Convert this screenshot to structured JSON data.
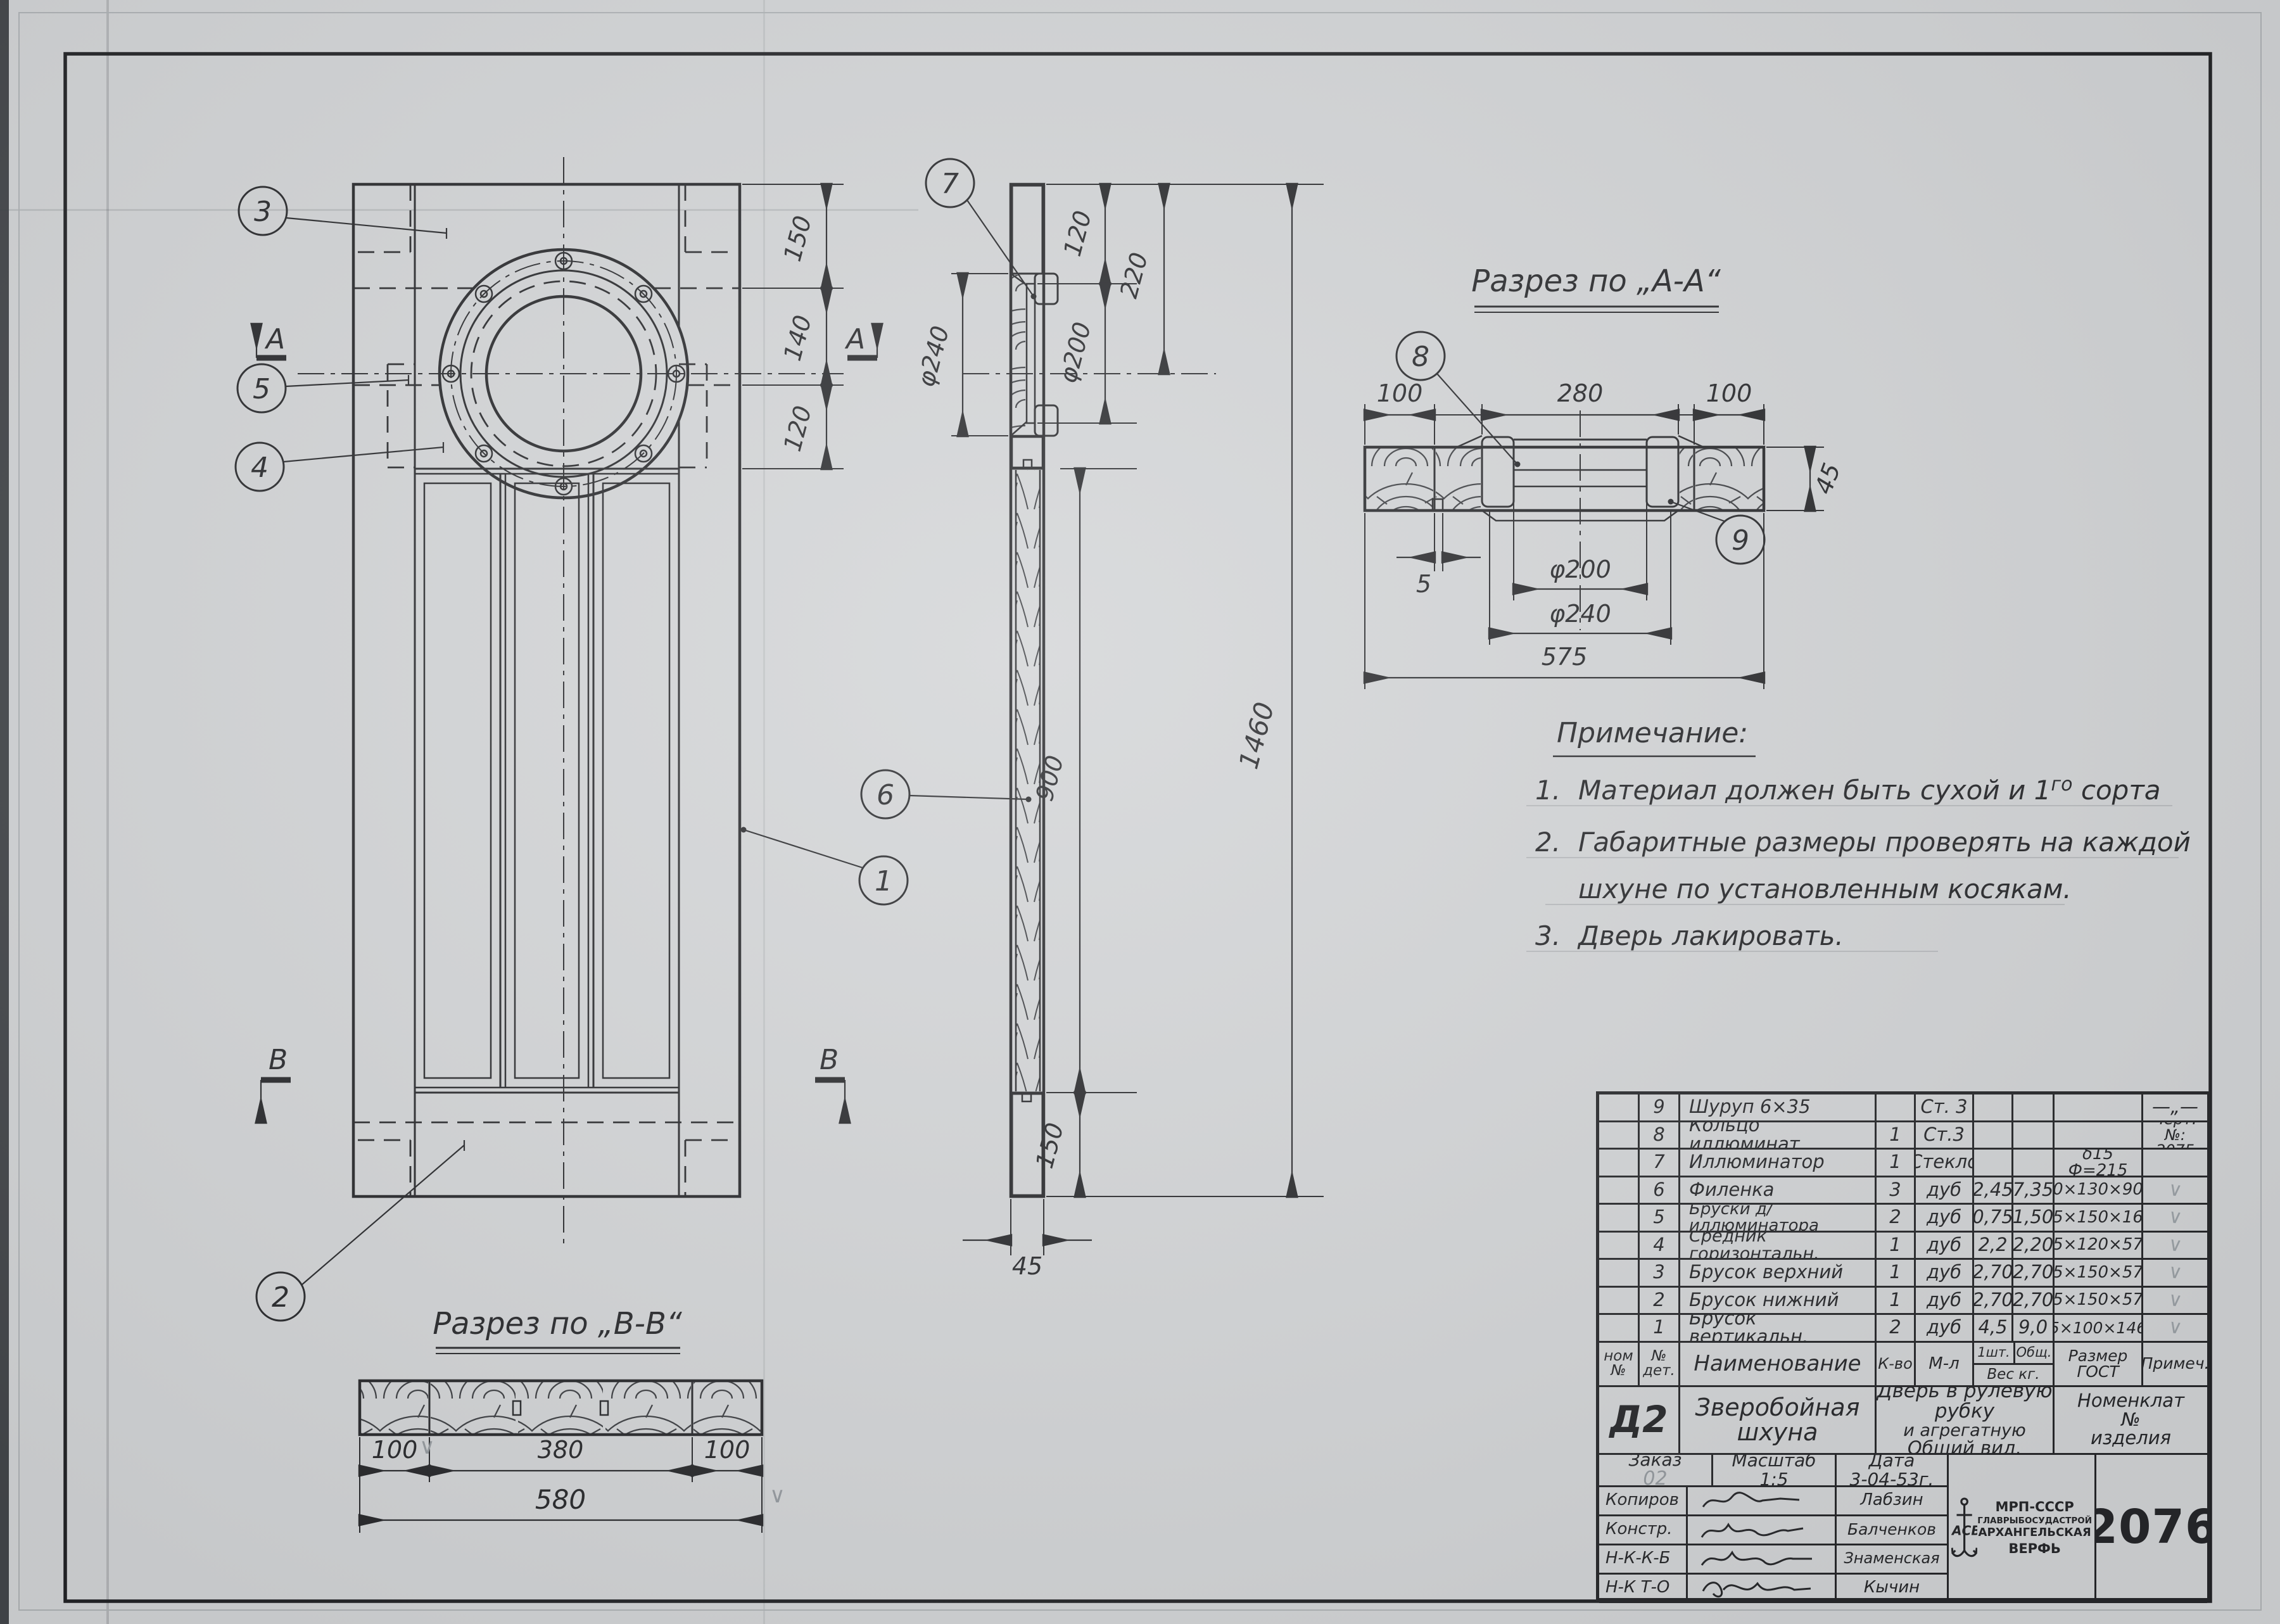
{
  "drawing": {
    "section_aa_title": "Разрез по „А-А“",
    "section_bb_title": "Разрез по „В-В“",
    "marker_a": "А",
    "marker_b": "В",
    "check": "∨",
    "callouts": {
      "c1": "1",
      "c2": "2",
      "c3": "3",
      "c4": "4",
      "c5": "5",
      "c6": "6",
      "c7": "7",
      "c8": "8",
      "c9": "9"
    },
    "front_dims": {
      "d150": "150",
      "d140": "140",
      "d120": "120"
    },
    "side_dims": {
      "d120": "120",
      "d220": "220",
      "d200": "φ200",
      "d240": "φ240",
      "d900": "900",
      "d1460": "1460",
      "d150": "150",
      "d45": "45"
    },
    "aa_dims": {
      "d100l": "100",
      "d280": "280",
      "d100r": "100",
      "d5": "5",
      "d200": "φ200",
      "d240": "φ240",
      "d575": "575",
      "d45": "45"
    },
    "bb_dims": {
      "d100l": "100",
      "d380": "380",
      "d100r": "100",
      "d580": "580"
    }
  },
  "notes": {
    "title": "Примечание:",
    "n1_no": "1.",
    "n1a": "Материал  должен  быть  сухой  и  1",
    "n1sup": "го",
    "n1b": "  сорта",
    "n2_no": "2.",
    "n2a": "Габаритные  размеры  проверять  на  каждой",
    "n2b": "шхуне  по  установленным  косякам.",
    "n3_no": "3.",
    "n3a": "Дверь  лакировать."
  },
  "parts": {
    "rows": [
      {
        "num": "9",
        "name": "Шуруп  6×35",
        "qty": "",
        "mat": "Ст. 3",
        "w1": "",
        "wt": "",
        "size": "",
        "note": "—„—"
      },
      {
        "num": "8",
        "name": "Кольцо иллюминат.",
        "qty": "1",
        "mat": "Ст.3",
        "w1": "",
        "wt": "",
        "size": "",
        "note_a": "Черт.№:",
        "note_b": "2075"
      },
      {
        "num": "7",
        "name": "Иллюминатор",
        "qty": "1",
        "mat": "Стекло",
        "w1": "",
        "wt": "",
        "size": "δ15 Ф=215",
        "note": ""
      },
      {
        "num": "6",
        "name": "Филенка",
        "qty": "3",
        "mat": "дуб",
        "w1": "2,45",
        "wt": "7,35",
        "size": "30×130×900",
        "note": "∨"
      },
      {
        "num": "5",
        "name": "Бруски д/иллюминатора",
        "qty": "2",
        "mat": "дуб",
        "w1": "0,75",
        "wt": "1,50",
        "size": "45×150×160",
        "note": "∨"
      },
      {
        "num": "4",
        "name": "Средник горизонтальн.",
        "qty": "1",
        "mat": "дуб",
        "w1": "2,2",
        "wt": "2,20",
        "size": "45×120×575",
        "note": "∨"
      },
      {
        "num": "3",
        "name": "Брусок верхний",
        "qty": "1",
        "mat": "дуб",
        "w1": "2,70",
        "wt": "2,70",
        "size": "45×150×575",
        "note": "∨"
      },
      {
        "num": "2",
        "name": "Брусок нижний",
        "qty": "1",
        "mat": "дуб",
        "w1": "2,70",
        "wt": "2,70",
        "size": "45×150×575",
        "note": "∨"
      },
      {
        "num": "1",
        "name": "Брусок вертикальн.",
        "qty": "2",
        "mat": "дуб",
        "w1": "4,5",
        "wt": "9,0",
        "size": "45×100×1460",
        "note": "∨"
      }
    ]
  },
  "table": {
    "headers": {
      "col_num_1": "ном",
      "col_num_2": "№",
      "col_det_1": "№",
      "col_det_2": "дет.",
      "col_name": "Наименование",
      "col_qty": "К-во",
      "col_mat": "М-л",
      "col_w1": "1шт.",
      "col_wt": "Общ.",
      "col_wkg": "Вес  кг.",
      "col_size_1": "Размер",
      "col_size_2": "ГОСТ",
      "col_note": "Примеч."
    }
  },
  "titleblock": {
    "code": "Д2",
    "project_l1": "Зверобойная",
    "project_l2": "шхуна",
    "title_l1": "Дверь в рулевую рубку",
    "title_l2": "и агрегатную",
    "title_l3": "Общий вид.",
    "nomen_l1": "Номенклат",
    "nomen_l2": "№",
    "nomen_l3": "изделия",
    "order_label": "Заказ",
    "order_value": "02",
    "scale_label": "Масштаб",
    "scale_value": "1:5",
    "date_label": "Дата",
    "date_value": "3-04-53г.",
    "sig_rows": [
      {
        "label": "Копиров",
        "name": "Лабзин"
      },
      {
        "label": "Констр.",
        "name": "Балченков"
      },
      {
        "label": "Н-К-К-Б",
        "name": "Знаменская"
      },
      {
        "label": "Н-К  Т-О",
        "name": "Кычин"
      }
    ],
    "org_l1": "МРП-СССР",
    "org_l2": "ГЛАВРЫБОСУДАСТРОЙ",
    "org_l3": "АРХАНГЕЛЬСКАЯ",
    "org_l4": "ВЕРФЬ",
    "logo": "АСВ",
    "sheet_number": "2076"
  }
}
